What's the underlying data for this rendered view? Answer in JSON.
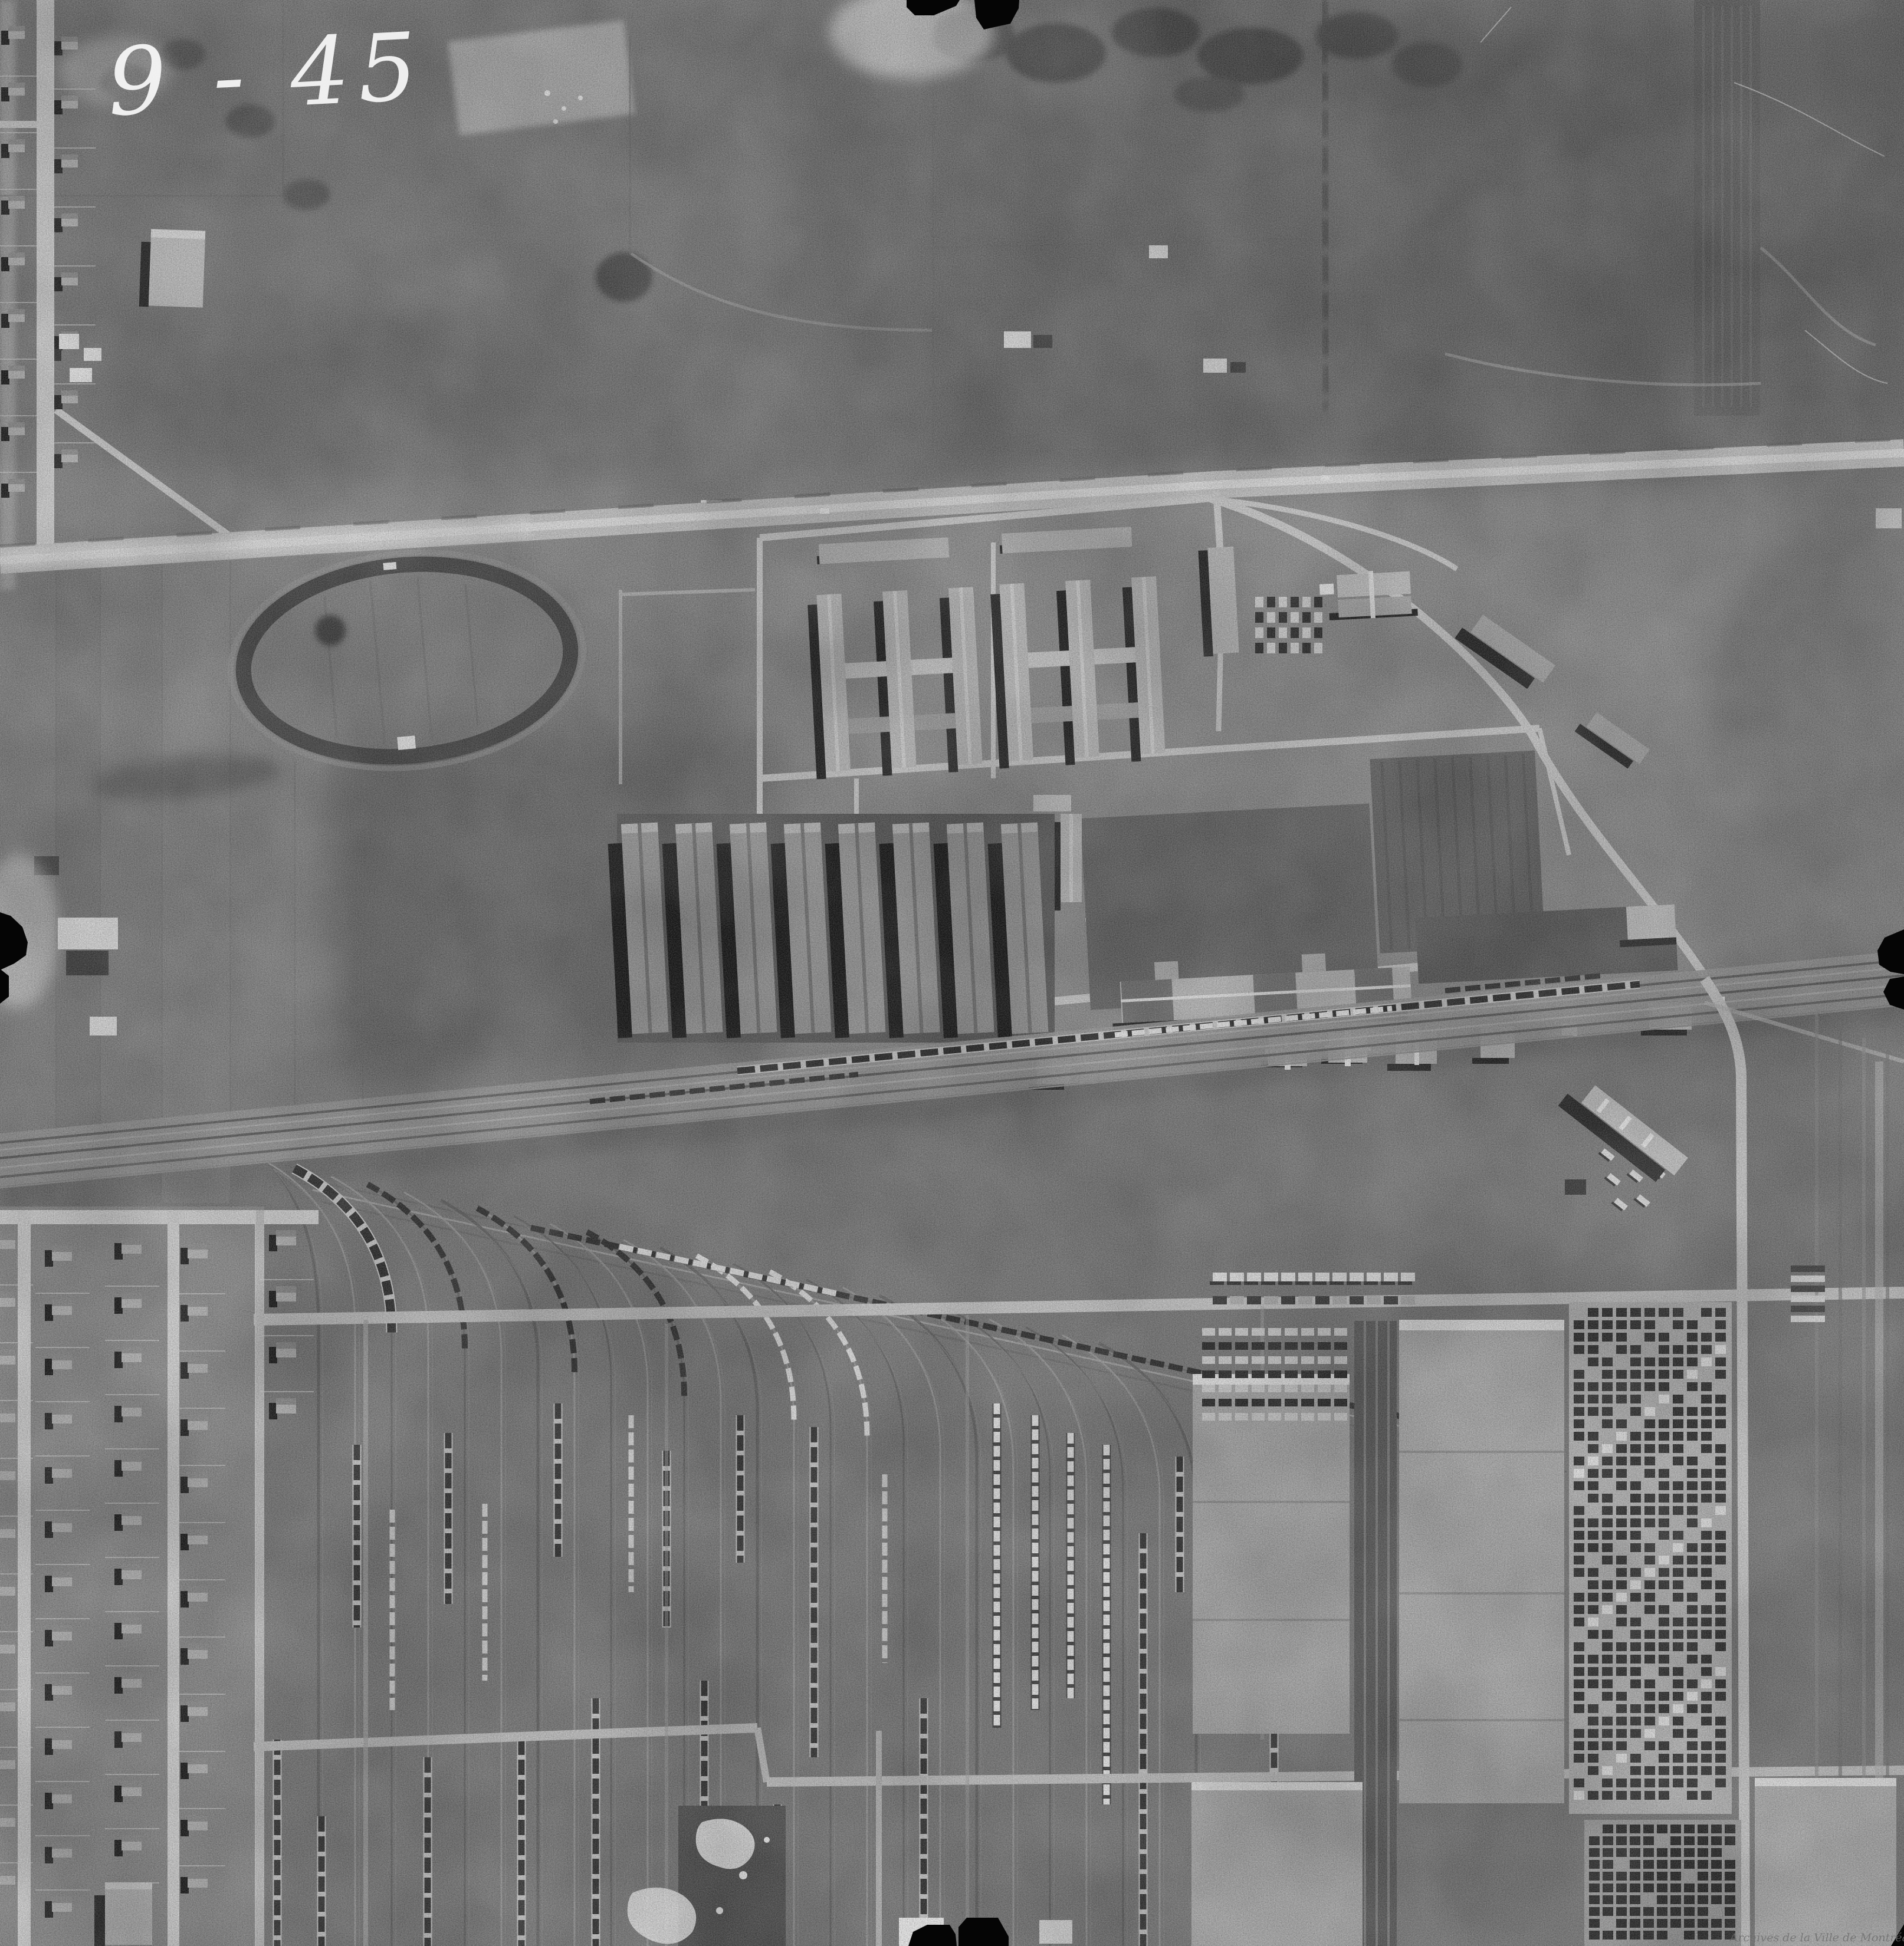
{
  "photo_viewer": {
    "handwritten_index": "9 - 45",
    "watermark_text": "Archives de la Ville de Montréal"
  },
  "palette": {
    "film_black": "#050505",
    "terrain_base": "#7f7f7f",
    "terrain_dark": "#5a5a5a",
    "road_light": "#c9c9c9",
    "roof_light": "#b6b6b6",
    "shadow_black": "#1b1b1b",
    "highlight_white": "#f1f1f1",
    "watermark_gray": "#6e6e6e"
  },
  "landmarks": [
    "racetrack-oval",
    "military-camp-barracks",
    "swimming-pool",
    "parade-ground",
    "main-boulevard",
    "railway-mainline",
    "classification-yard-fan",
    "freight-car-strings",
    "warehouses",
    "container-storage",
    "residential-grid",
    "fiducial-marks"
  ]
}
